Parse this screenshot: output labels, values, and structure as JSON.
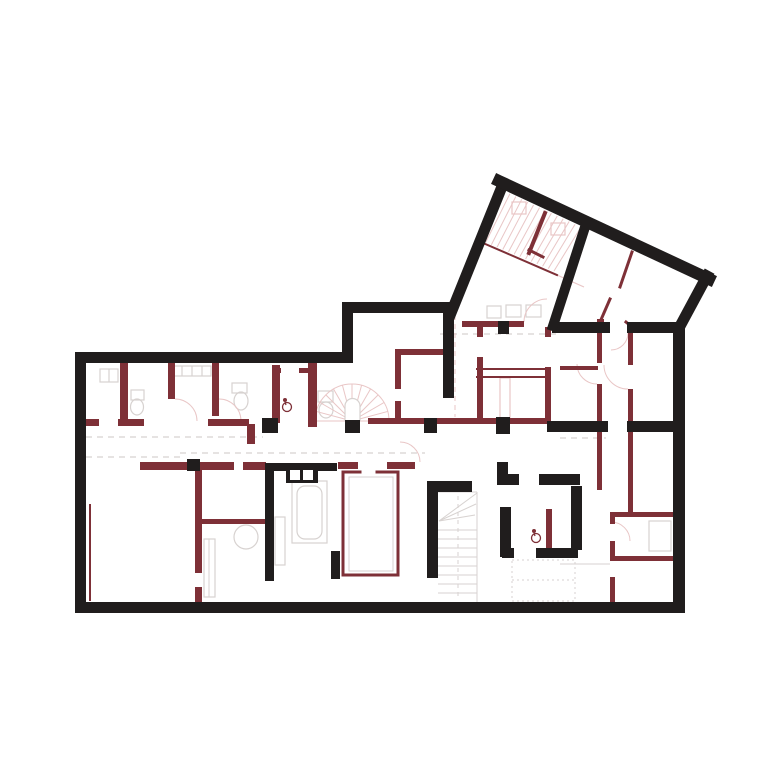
{
  "canvas": {
    "width": 780,
    "height": 767,
    "background": "#ffffff"
  },
  "palette": {
    "bk": "#201d1d",
    "rd": "#7e3037",
    "pk": "#d9a4a4",
    "lp": "#e9c6c6",
    "gy": "#d7d2d0",
    "wh": "#ffffff"
  },
  "layers": {
    "dashes": [
      {
        "t": "l",
        "x1": 86,
        "y1": 437,
        "x2": 263,
        "y2": 437,
        "c": "gy",
        "w": 1.2,
        "dash": "6 5"
      },
      {
        "t": "l",
        "x1": 86,
        "y1": 457,
        "x2": 180,
        "y2": 457,
        "c": "gy",
        "w": 1.2,
        "dash": "6 5"
      },
      {
        "t": "l",
        "x1": 180,
        "y1": 453,
        "x2": 425,
        "y2": 453,
        "c": "gy",
        "w": 1.2,
        "dash": "6 5"
      },
      {
        "t": "l",
        "x1": 440,
        "y1": 334,
        "x2": 558,
        "y2": 334,
        "c": "gy",
        "w": 1.2,
        "dash": "6 5"
      },
      {
        "t": "l",
        "x1": 560,
        "y1": 438,
        "x2": 606,
        "y2": 438,
        "c": "gy",
        "w": 1.2,
        "dash": "6 5"
      },
      {
        "t": "l",
        "x1": 455,
        "y1": 315,
        "x2": 455,
        "y2": 417,
        "c": "lp",
        "w": 1,
        "dash": "5 4"
      },
      {
        "t": "r",
        "x": 512,
        "y": 560,
        "w": 63,
        "h": 41,
        "s": "gy",
        "w2": 1,
        "dash": "2 3"
      },
      {
        "t": "l",
        "x1": 512,
        "y1": 580,
        "x2": 575,
        "y2": 580,
        "c": "gy",
        "w": 1,
        "dash": "2 3"
      },
      {
        "t": "l",
        "x1": 458,
        "y1": 496,
        "x2": 458,
        "y2": 598,
        "c": "gy",
        "w": 1,
        "dash": "4 4"
      }
    ],
    "furniture": [
      {
        "t": "r",
        "x": 100,
        "y": 369,
        "w": 18,
        "h": 13,
        "s": "gy",
        "w2": 1.2
      },
      {
        "t": "l",
        "x1": 109,
        "y1": 369,
        "x2": 109,
        "y2": 382,
        "c": "gy",
        "w": 1.2
      },
      {
        "t": "r",
        "x": 131,
        "y": 390,
        "w": 13,
        "h": 10,
        "s": "gy",
        "w2": 1.2
      },
      {
        "t": "e",
        "cx": 137,
        "cy": 407,
        "rx": 6.5,
        "ry": 8,
        "s": "gy",
        "w2": 1.2
      },
      {
        "t": "r",
        "x": 172,
        "y": 366,
        "w": 39,
        "h": 10,
        "s": "gy",
        "w2": 1.2
      },
      {
        "t": "l",
        "x1": 182,
        "y1": 366,
        "x2": 182,
        "y2": 376,
        "c": "gy",
        "w": 1.2
      },
      {
        "t": "l",
        "x1": 192,
        "y1": 366,
        "x2": 192,
        "y2": 376,
        "c": "gy",
        "w": 1.2
      },
      {
        "t": "l",
        "x1": 202,
        "y1": 366,
        "x2": 202,
        "y2": 376,
        "c": "gy",
        "w": 1.2
      },
      {
        "t": "r",
        "x": 232,
        "y": 383,
        "w": 15,
        "h": 10,
        "s": "gy",
        "w2": 1.2
      },
      {
        "t": "e",
        "cx": 241,
        "cy": 401,
        "rx": 7,
        "ry": 9,
        "s": "gy",
        "w2": 1.2
      },
      {
        "t": "r",
        "x": 318,
        "y": 391,
        "w": 15,
        "h": 11,
        "s": "gy",
        "w2": 1.2
      },
      {
        "t": "e",
        "cx": 326,
        "cy": 410,
        "rx": 7,
        "ry": 8,
        "s": "gy",
        "w2": 1.2
      },
      {
        "t": "r",
        "x": 487,
        "y": 306,
        "w": 14,
        "h": 12,
        "s": "gy",
        "w2": 1.2
      },
      {
        "t": "r",
        "x": 506,
        "y": 305,
        "w": 15,
        "h": 12,
        "s": "gy",
        "w2": 1.2
      },
      {
        "t": "r",
        "x": 526,
        "y": 305,
        "w": 15,
        "h": 12,
        "s": "gy",
        "w2": 1.2
      },
      {
        "t": "r",
        "x": 292,
        "y": 481,
        "w": 35,
        "h": 62,
        "s": "gy",
        "w2": 1.2
      },
      {
        "t": "r",
        "x": 297,
        "y": 486,
        "w": 25,
        "h": 53,
        "s": "gy",
        "w2": 1.2,
        "rx": 8
      },
      {
        "t": "r",
        "x": 275,
        "y": 517,
        "w": 10,
        "h": 48,
        "s": "gy",
        "w2": 1.2
      },
      {
        "t": "r",
        "x": 204,
        "y": 539,
        "w": 11,
        "h": 58,
        "s": "gy",
        "w2": 1.2
      },
      {
        "t": "l",
        "x1": 209,
        "y1": 539,
        "x2": 209,
        "y2": 597,
        "c": "gy",
        "w": 1
      },
      {
        "t": "e",
        "cx": 246,
        "cy": 537,
        "rx": 12,
        "ry": 12,
        "s": "gy",
        "w2": 1.2
      },
      {
        "t": "r",
        "x": 649,
        "y": 521,
        "w": 22,
        "h": 30,
        "s": "gy",
        "w2": 1.2
      },
      {
        "t": "r",
        "x": 349,
        "y": 477,
        "w": 44,
        "h": 94,
        "s": "gy",
        "w2": 1
      },
      {
        "t": "l",
        "x1": 560,
        "y1": 564,
        "x2": 610,
        "y2": 564,
        "c": "gy",
        "w": 1
      }
    ],
    "stairs": [
      {
        "t": "fan",
        "cx": 352,
        "cy": 421,
        "r": 37,
        "a0": 180,
        "a1": 360,
        "n": 12,
        "c": "lp",
        "w": 1
      },
      {
        "t": "p",
        "d": "M345,421 L345,406 A7.5,7.5 0 0 1 360,406 L360,421",
        "s": "gy",
        "w2": 1.2,
        "f": "wh"
      },
      {
        "t": "l",
        "x1": 477,
        "y1": 492,
        "x2": 477,
        "y2": 602,
        "c": "gy",
        "w": 1
      },
      {
        "t": "l",
        "x1": 438,
        "y1": 492,
        "x2": 477,
        "y2": 492,
        "c": "gy",
        "w": 1
      },
      {
        "t": "l",
        "x1": 439,
        "y1": 521,
        "x2": 477,
        "y2": 493,
        "c": "gy",
        "w": 1
      },
      {
        "t": "l",
        "x1": 439,
        "y1": 521,
        "x2": 476,
        "y2": 504,
        "c": "gy",
        "w": 1
      },
      {
        "t": "l",
        "x1": 439,
        "y1": 521,
        "x2": 475,
        "y2": 515,
        "c": "gy",
        "w": 1
      },
      {
        "t": "rep",
        "x1": 438,
        "y1": 530,
        "x2": 477,
        "y2": 530,
        "dy": 9,
        "n": 8,
        "c": "gy",
        "w": 1
      }
    ],
    "hatch": {
      "a": [
        504,
        191,
        581,
        227
      ],
      "b": [
        480,
        240,
        554,
        271
      ],
      "n": 14,
      "c": "lp",
      "w": 1
    },
    "pinks": [
      {
        "t": "r",
        "x": 512,
        "y": 202,
        "w": 14,
        "h": 12,
        "s": "lp",
        "w2": 1.2
      },
      {
        "t": "r",
        "x": 551,
        "y": 223,
        "w": 14,
        "h": 12,
        "s": "lp",
        "w2": 1.2
      },
      {
        "t": "r",
        "x": 500,
        "y": 378,
        "w": 10,
        "h": 40,
        "s": "lp",
        "w2": 1.2
      },
      {
        "t": "l",
        "x1": 557,
        "y1": 275,
        "x2": 584,
        "y2": 287,
        "c": "lp",
        "w": 1.2
      },
      {
        "t": "p",
        "d": "M175,399 A22,22 0 0 1 197,421",
        "s": "lp",
        "w2": 1
      },
      {
        "t": "p",
        "d": "M219,399 A22,22 0 0 1 241,421",
        "s": "lp",
        "w2": 1
      },
      {
        "t": "p",
        "d": "M628,333 A17,17 0 0 1 611,350",
        "s": "lp",
        "w2": 1
      },
      {
        "t": "p",
        "d": "M420,462 A20,20 0 0 0 400,442",
        "s": "lp",
        "w2": 1
      },
      {
        "t": "p",
        "d": "M597,384 A20,20 0 0 1 577,364",
        "s": "lp",
        "w2": 1
      },
      {
        "t": "p",
        "d": "M628,389 A24,24 0 0 1 604,365",
        "s": "lp",
        "w2": 1
      },
      {
        "t": "p",
        "d": "M524,322 A23,23 0 0 1 547,299",
        "s": "lp",
        "w2": 1
      },
      {
        "t": "p",
        "d": "M611,522 A19,19 0 0 1 630,541",
        "s": "lp",
        "w2": 1
      }
    ],
    "redRects": [
      {
        "x": 120,
        "y": 363,
        "w": 8,
        "h": 62
      },
      {
        "x": 168,
        "y": 363,
        "w": 7,
        "h": 36
      },
      {
        "x": 212,
        "y": 363,
        "w": 7,
        "h": 53
      },
      {
        "x": 272,
        "y": 365,
        "w": 8,
        "h": 58
      },
      {
        "x": 308,
        "y": 363,
        "w": 9,
        "h": 64
      },
      {
        "x": 272,
        "y": 368,
        "w": 9,
        "h": 5
      },
      {
        "x": 299,
        "y": 368,
        "w": 9,
        "h": 5
      },
      {
        "x": 85,
        "y": 419,
        "w": 14,
        "h": 7
      },
      {
        "x": 118,
        "y": 419,
        "w": 26,
        "h": 7
      },
      {
        "x": 208,
        "y": 419,
        "w": 41,
        "h": 7
      },
      {
        "x": 247,
        "y": 424,
        "w": 8,
        "h": 20
      },
      {
        "x": 200,
        "y": 354,
        "w": 11,
        "h": 8
      },
      {
        "x": 323,
        "y": 354,
        "w": 30,
        "h": 9
      },
      {
        "x": 140,
        "y": 462,
        "w": 49,
        "h": 8
      },
      {
        "x": 200,
        "y": 462,
        "w": 34,
        "h": 8
      },
      {
        "x": 243,
        "y": 462,
        "w": 23,
        "h": 8
      },
      {
        "x": 195,
        "y": 470,
        "w": 7,
        "h": 103
      },
      {
        "x": 195,
        "y": 587,
        "w": 7,
        "h": 16
      },
      {
        "x": 200,
        "y": 519,
        "w": 68,
        "h": 5
      },
      {
        "x": 395,
        "y": 349,
        "w": 49,
        "h": 6
      },
      {
        "x": 395,
        "y": 349,
        "w": 6,
        "h": 40
      },
      {
        "x": 395,
        "y": 401,
        "w": 6,
        "h": 23
      },
      {
        "x": 368,
        "y": 418,
        "w": 57,
        "h": 6
      },
      {
        "x": 437,
        "y": 418,
        "w": 60,
        "h": 6
      },
      {
        "x": 510,
        "y": 418,
        "w": 38,
        "h": 6
      },
      {
        "x": 477,
        "y": 327,
        "w": 6,
        "h": 10
      },
      {
        "x": 477,
        "y": 357,
        "w": 6,
        "h": 67
      },
      {
        "x": 545,
        "y": 327,
        "w": 6,
        "h": 10
      },
      {
        "x": 545,
        "y": 367,
        "w": 6,
        "h": 57
      },
      {
        "x": 462,
        "y": 321,
        "w": 36,
        "h": 6
      },
      {
        "x": 509,
        "y": 321,
        "w": 15,
        "h": 6
      },
      {
        "x": 597,
        "y": 319,
        "w": 7,
        "h": 14
      },
      {
        "x": 597,
        "y": 333,
        "w": 5,
        "h": 30
      },
      {
        "x": 597,
        "y": 384,
        "w": 5,
        "h": 38
      },
      {
        "x": 628,
        "y": 333,
        "w": 5,
        "h": 32
      },
      {
        "x": 628,
        "y": 389,
        "w": 5,
        "h": 33
      },
      {
        "x": 560,
        "y": 366,
        "w": 38,
        "h": 4
      },
      {
        "x": 597,
        "y": 432,
        "w": 5,
        "h": 58
      },
      {
        "x": 628,
        "y": 432,
        "w": 5,
        "h": 83
      },
      {
        "x": 610,
        "y": 512,
        "w": 63,
        "h": 5
      },
      {
        "x": 610,
        "y": 556,
        "w": 63,
        "h": 5
      },
      {
        "x": 610,
        "y": 512,
        "w": 5,
        "h": 12
      },
      {
        "x": 610,
        "y": 541,
        "w": 5,
        "h": 17
      },
      {
        "x": 610,
        "y": 577,
        "w": 5,
        "h": 26
      },
      {
        "x": 546,
        "y": 509,
        "w": 6,
        "h": 39
      },
      {
        "x": 258,
        "y": 602,
        "w": 70,
        "h": 11
      },
      {
        "x": 337,
        "y": 602,
        "w": 41,
        "h": 11
      },
      {
        "x": 86,
        "y": 602,
        "w": 15,
        "h": 11
      },
      {
        "x": 338,
        "y": 462,
        "w": 20,
        "h": 7
      },
      {
        "x": 387,
        "y": 462,
        "w": 28,
        "h": 7
      }
    ],
    "redPaths": [
      {
        "d": "M343,472 L343,575 L398,575 L398,472 L377,472 M360,472 L343,472",
        "w2": 3
      },
      {
        "d": "M90,505 L90,600",
        "w2": 2
      },
      {
        "d": "M477,369 L546,369",
        "w2": 2
      },
      {
        "d": "M477,377 L546,377",
        "w2": 2
      },
      {
        "d": "M632,252 L620,287",
        "w2": 3
      },
      {
        "d": "M610,299 L600,322",
        "w2": 3
      },
      {
        "d": "M545,213 L529,253",
        "w2": 4
      },
      {
        "d": "M529,250 L543,257",
        "w2": 3
      },
      {
        "d": "M483,243 L557,275",
        "w2": 2
      },
      {
        "d": "M626,322 L637,331",
        "w2": 3
      }
    ],
    "blackRects": [
      {
        "x": 75,
        "y": 352,
        "w": 11,
        "h": 261
      },
      {
        "x": 75,
        "y": 352,
        "w": 278,
        "h": 11
      },
      {
        "x": 342,
        "y": 302,
        "w": 11,
        "h": 61
      },
      {
        "x": 342,
        "y": 302,
        "w": 112,
        "h": 11
      },
      {
        "x": 673,
        "y": 322,
        "w": 12,
        "h": 291
      },
      {
        "x": 75,
        "y": 602,
        "w": 610,
        "h": 11
      },
      {
        "x": 552,
        "y": 322,
        "w": 58,
        "h": 11
      },
      {
        "x": 627,
        "y": 322,
        "w": 58,
        "h": 11
      },
      {
        "x": 547,
        "y": 421,
        "w": 61,
        "h": 11
      },
      {
        "x": 627,
        "y": 421,
        "w": 58,
        "h": 11
      },
      {
        "x": 443,
        "y": 310,
        "w": 11,
        "h": 88
      },
      {
        "x": 265,
        "y": 465,
        "w": 9,
        "h": 116
      },
      {
        "x": 265,
        "y": 463,
        "w": 72,
        "h": 8
      },
      {
        "x": 427,
        "y": 481,
        "w": 11,
        "h": 97
      },
      {
        "x": 427,
        "y": 481,
        "w": 45,
        "h": 11
      },
      {
        "x": 497,
        "y": 462,
        "w": 11,
        "h": 13
      },
      {
        "x": 497,
        "y": 474,
        "w": 22,
        "h": 11
      },
      {
        "x": 539,
        "y": 474,
        "w": 41,
        "h": 11
      },
      {
        "x": 500,
        "y": 507,
        "w": 11,
        "h": 50
      },
      {
        "x": 502,
        "y": 548,
        "w": 12,
        "h": 10
      },
      {
        "x": 536,
        "y": 548,
        "w": 42,
        "h": 10
      },
      {
        "x": 571,
        "y": 486,
        "w": 11,
        "h": 64
      },
      {
        "x": 331,
        "y": 551,
        "w": 9,
        "h": 28
      },
      {
        "x": 286,
        "y": 467,
        "w": 32,
        "h": 16
      },
      {
        "x": 262,
        "y": 418,
        "w": 16,
        "h": 15
      },
      {
        "x": 345,
        "y": 420,
        "w": 15,
        "h": 13
      },
      {
        "x": 424,
        "y": 418,
        "w": 13,
        "h": 15
      },
      {
        "x": 496,
        "y": 417,
        "w": 14,
        "h": 17
      },
      {
        "x": 187,
        "y": 459,
        "w": 13,
        "h": 12
      },
      {
        "x": 498,
        "y": 321,
        "w": 11,
        "h": 13
      }
    ],
    "blackPaths": [
      {
        "d": "M451,313 L503,184",
        "w2": 11
      },
      {
        "d": "M499,181 L709,279",
        "w2": 12
      },
      {
        "d": "M707,276 L679,328",
        "w2": 11
      },
      {
        "d": "M586,224 L553,326",
        "w2": 10
      }
    ],
    "whiteRects": [
      {
        "x": 290,
        "y": 470,
        "w": 10,
        "h": 10
      },
      {
        "x": 303,
        "y": 470,
        "w": 10,
        "h": 10
      }
    ],
    "icons": [
      {
        "t": "drain",
        "cx": 287,
        "cy": 407
      },
      {
        "t": "drain",
        "cx": 536,
        "cy": 538
      }
    ]
  }
}
